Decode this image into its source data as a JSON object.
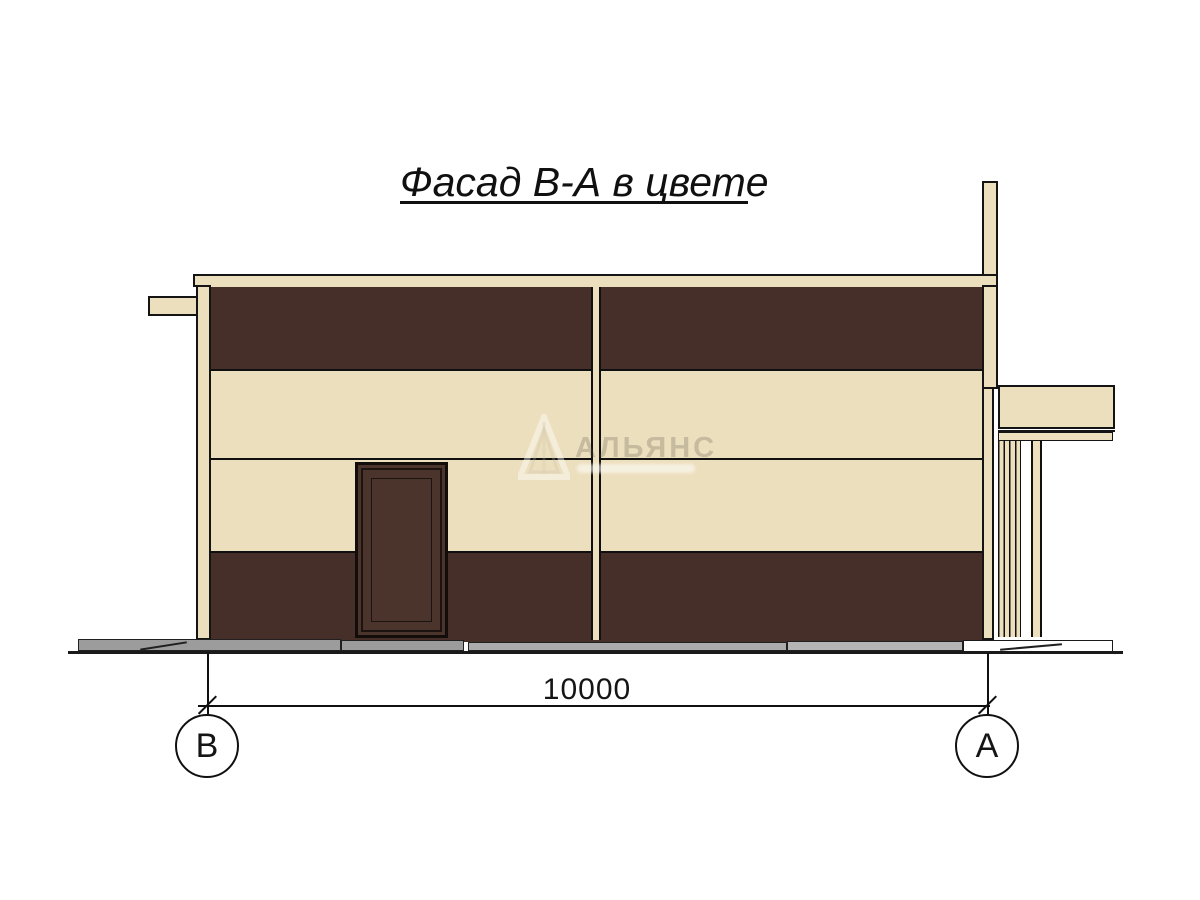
{
  "page": {
    "title": "Фасад В-А в цвете"
  },
  "dimension": {
    "value": "10000"
  },
  "axis_markers": {
    "left": "В",
    "right": "А"
  },
  "watermark": {
    "text": "АЛЬЯНС"
  },
  "colors": {
    "background": "#FFFFFF",
    "cream": "#ECDFBD",
    "dark_brown": "#452F28",
    "door_brown": "#4A342C",
    "outline": "#141414",
    "ink": "#101010",
    "plinth_gray": "#9C9C9C",
    "plinth_gray_mid": "#ABABAB",
    "plinth_gray_light": "#B5B5B5"
  }
}
